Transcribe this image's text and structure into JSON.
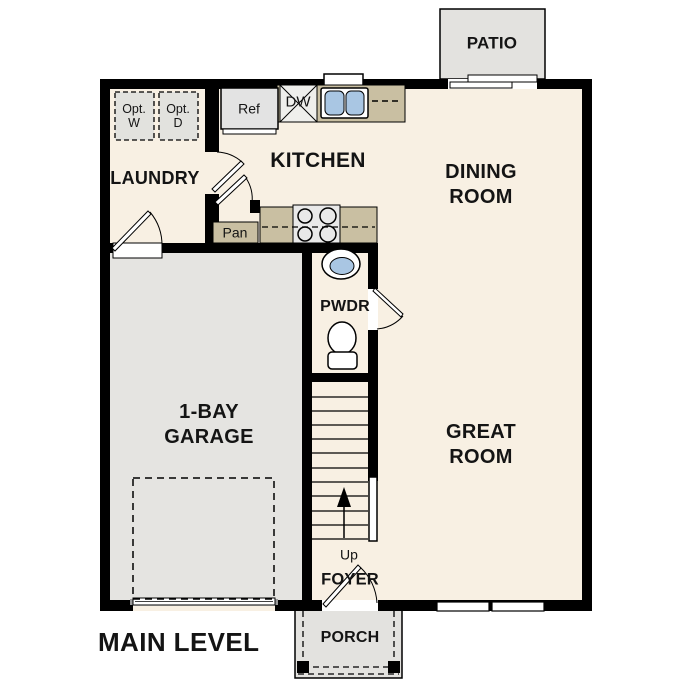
{
  "level": {
    "label": "MAIN LEVEL"
  },
  "rooms": {
    "patio": {
      "label": "PATIO"
    },
    "laundry": {
      "label": "LAUNDRY"
    },
    "kitchen": {
      "label": "KITCHEN"
    },
    "dining_room": {
      "line1": "DINING",
      "line2": "ROOM"
    },
    "great_room": {
      "line1": "GREAT",
      "line2": "ROOM"
    },
    "garage": {
      "line1": "1-BAY",
      "line2": "GARAGE"
    },
    "powder_room": {
      "label": "PWDR"
    },
    "foyer": {
      "label": "FOYER"
    },
    "porch": {
      "label": "PORCH"
    }
  },
  "fixtures": {
    "refrigerator": {
      "label": "Ref"
    },
    "dishwasher": {
      "label": "DW"
    },
    "pantry": {
      "label": "Pan"
    },
    "stairs": {
      "label": "Up"
    },
    "optional_washer": {
      "line1": "Opt.",
      "line2": "W"
    },
    "optional_dryer": {
      "line1": "Opt.",
      "line2": "D"
    }
  },
  "colors": {
    "wall": "#000000",
    "interior_floor": "#f8f0e3",
    "exterior_concrete": "#e3e2df",
    "counter": "#c9bfa2",
    "sink_basin": "#a9c6e3",
    "appliance": "#e3e3e3"
  }
}
